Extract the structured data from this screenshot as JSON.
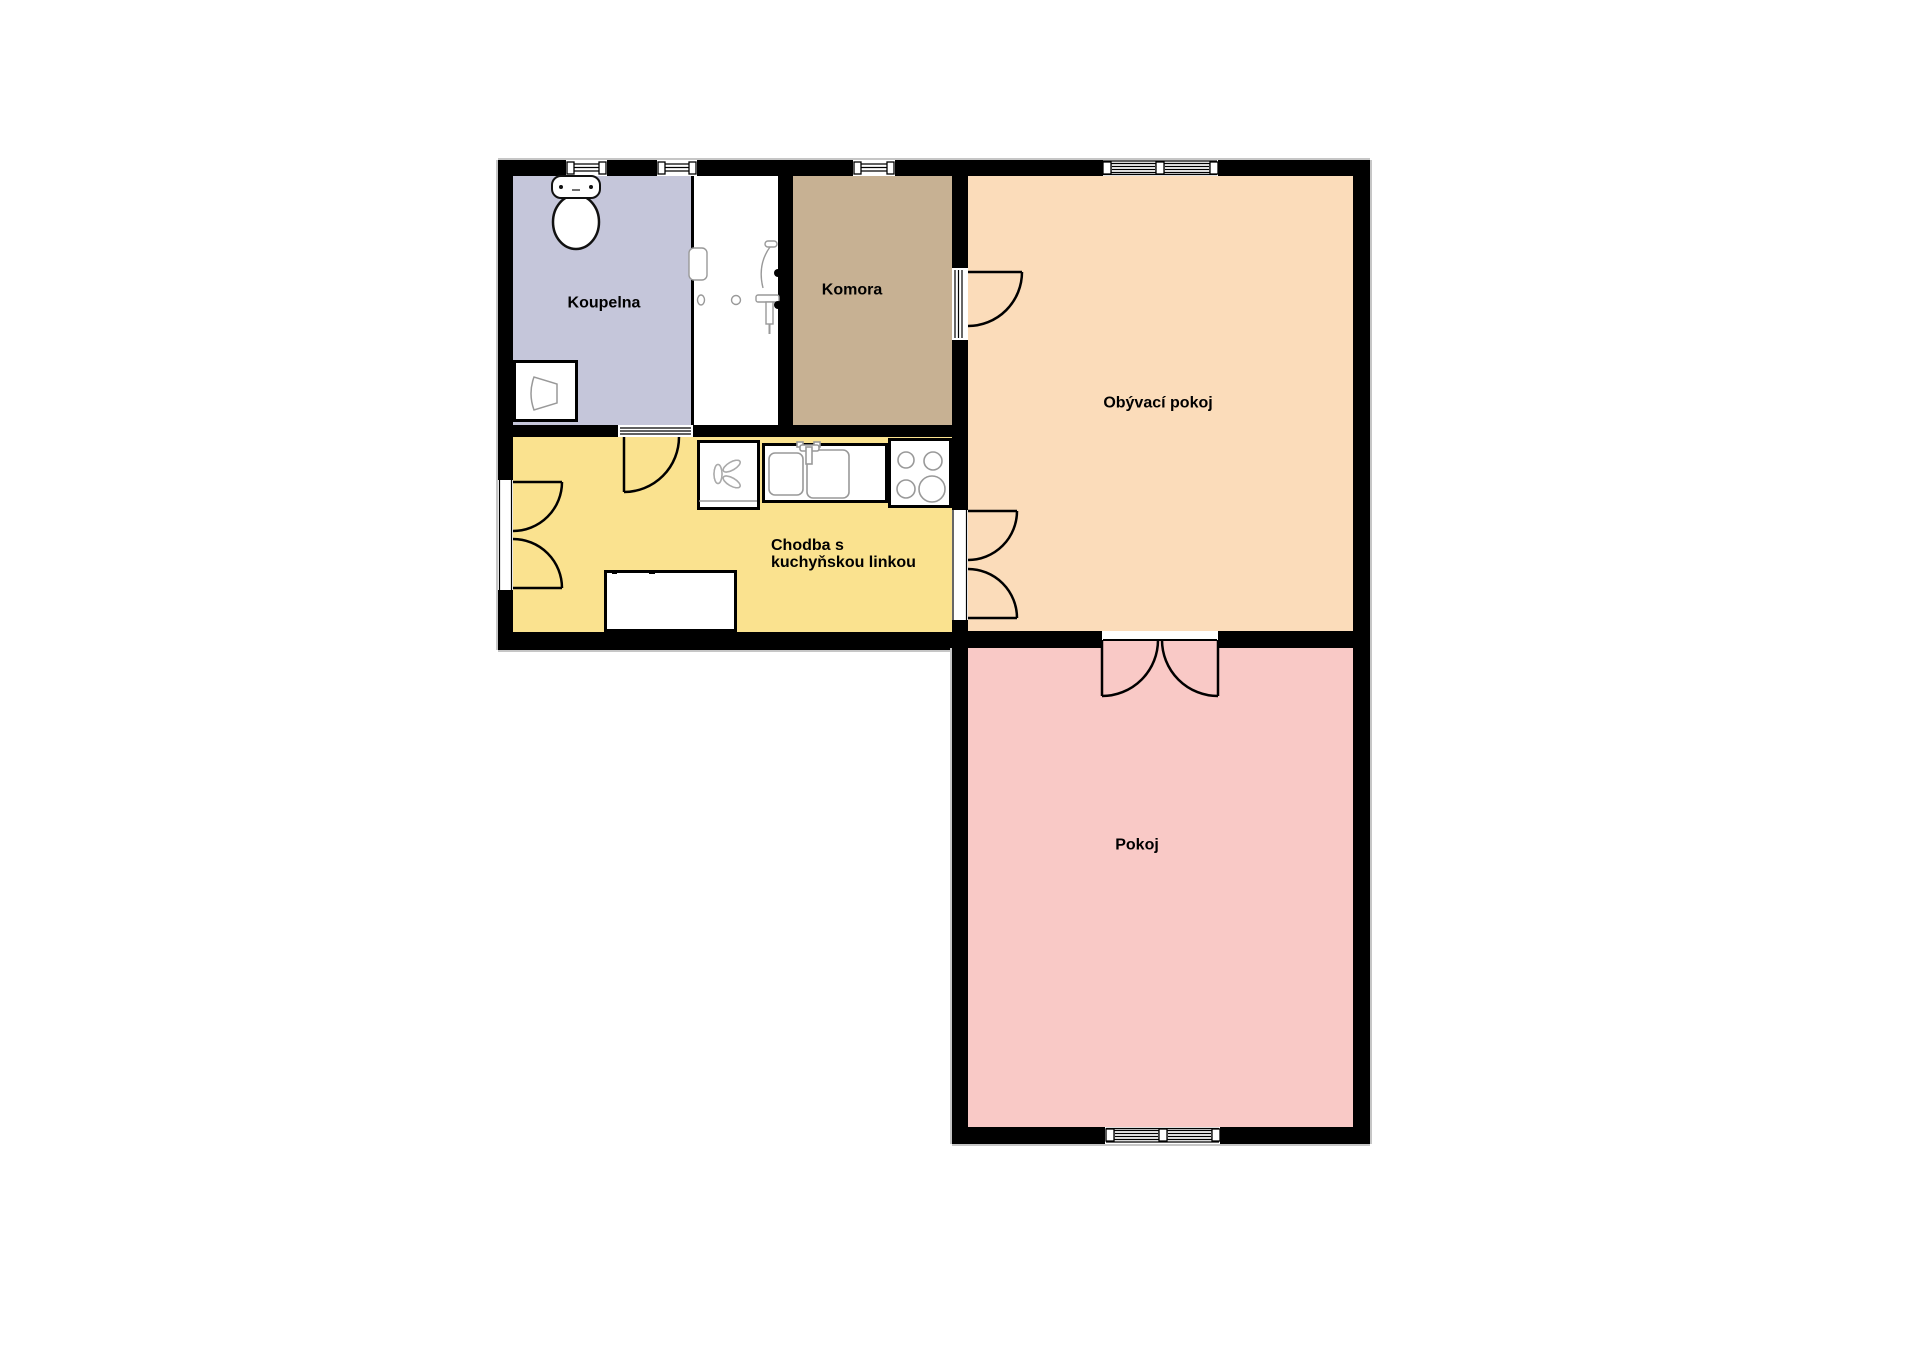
{
  "canvas": {
    "background": "#ffffff"
  },
  "palette": {
    "wall": "#000000",
    "fixture_fill": "#ffffff",
    "fixture_detail": "#999999"
  },
  "rooms": {
    "koupelna": {
      "label": "Koupelna",
      "color": "#c5c6da"
    },
    "komora": {
      "label": "Komora",
      "color": "#c7b193"
    },
    "obyvaci_pokoj": {
      "label": "Obývací pokoj",
      "color": "#fbdcba"
    },
    "chodba": {
      "label_line1": "Chodba s",
      "label_line2": "kuchyňskou linkou",
      "color": "#fae28f"
    },
    "pokoj": {
      "label": "Pokoj",
      "color": "#f9c9c6"
    },
    "bathtub_strip": {
      "color": "#ffffff"
    }
  },
  "fixtures": [
    {
      "name": "toilet",
      "room": "Koupelna"
    },
    {
      "name": "washing-machine",
      "room": "Koupelna"
    },
    {
      "name": "bathtub-shower",
      "room": "Koupelna"
    },
    {
      "name": "water-heater-fan",
      "room": "Chodba s kuchyňskou linkou"
    },
    {
      "name": "kitchen-sink",
      "room": "Chodba s kuchyňskou linkou"
    },
    {
      "name": "stove-cooktop",
      "room": "Chodba s kuchyňskou linkou"
    },
    {
      "name": "table-cabinet",
      "room": "Chodba s kuchyňskou linkou"
    }
  ]
}
